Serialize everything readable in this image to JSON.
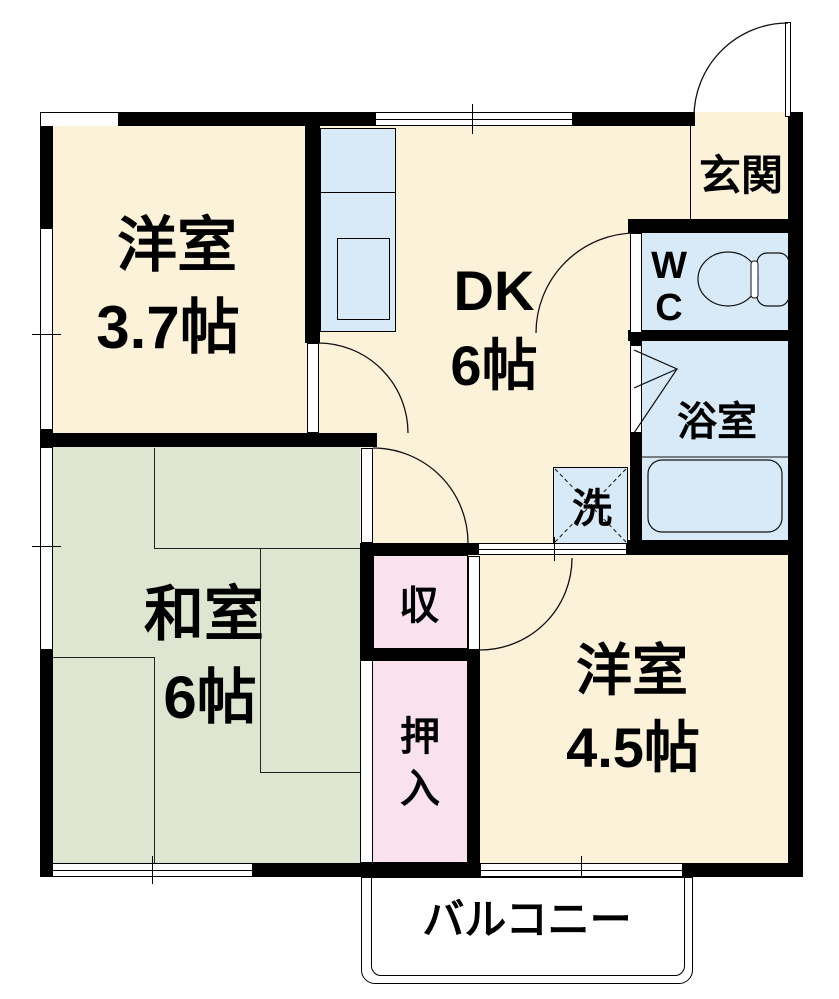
{
  "floorplan": {
    "type": "apartment-floor-plan",
    "rooms": {
      "western_room_37": {
        "name": "洋室",
        "size": "3.7帖"
      },
      "dk": {
        "name": "DK",
        "size": "6帖"
      },
      "washitsu": {
        "name": "和室",
        "size": "6帖"
      },
      "western_room_45": {
        "name": "洋室",
        "size": "4.5帖"
      },
      "genkan": {
        "label": "玄関"
      },
      "wc": {
        "line1": "W",
        "line2": "C"
      },
      "bathroom": {
        "label": "浴室"
      },
      "laundry": {
        "label": "洗"
      },
      "storage": {
        "label": "収"
      },
      "oshiire": {
        "char1": "押",
        "char2": "入"
      },
      "balcony": {
        "label": "バルコニー"
      }
    },
    "colors": {
      "western_floor": "#FCF2DA",
      "tatami_floor": "#DEE5D1",
      "closet_pink": "#F9E2EE",
      "wet_blue": "#D8EAF8",
      "wall_black": "#000000",
      "balcony_white": "#FFFFFF"
    }
  }
}
